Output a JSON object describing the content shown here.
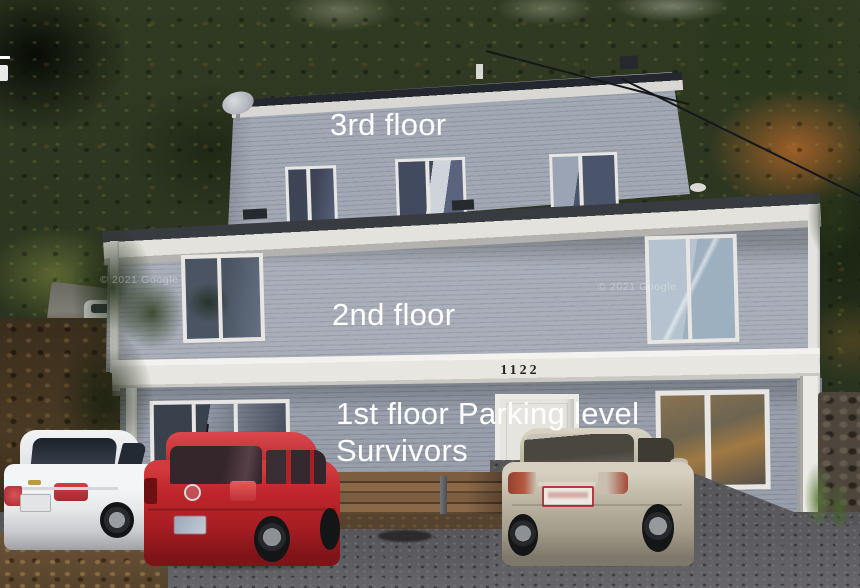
{
  "labels": {
    "floor3": "3rd floor",
    "floor2": "2nd floor",
    "floor1_line1": "1st floor Parking level",
    "floor1_line2": "Survivors"
  },
  "house": {
    "number": "1122"
  },
  "watermarks": {
    "google": "© 2021 Google"
  },
  "colors": {
    "label_text": "#ffffff",
    "house_number_text": "#2a221a",
    "siding_gray": "#9aa0ae",
    "trim_white": "#e9e8e3",
    "roof_dark": "#24272d",
    "car_white": "#ececee",
    "car_red": "#c0262b",
    "car_silver": "#bdb6a4",
    "foliage_orange": "#b06a2a",
    "watermark_text": "rgba(255,255,255,0.33)"
  }
}
